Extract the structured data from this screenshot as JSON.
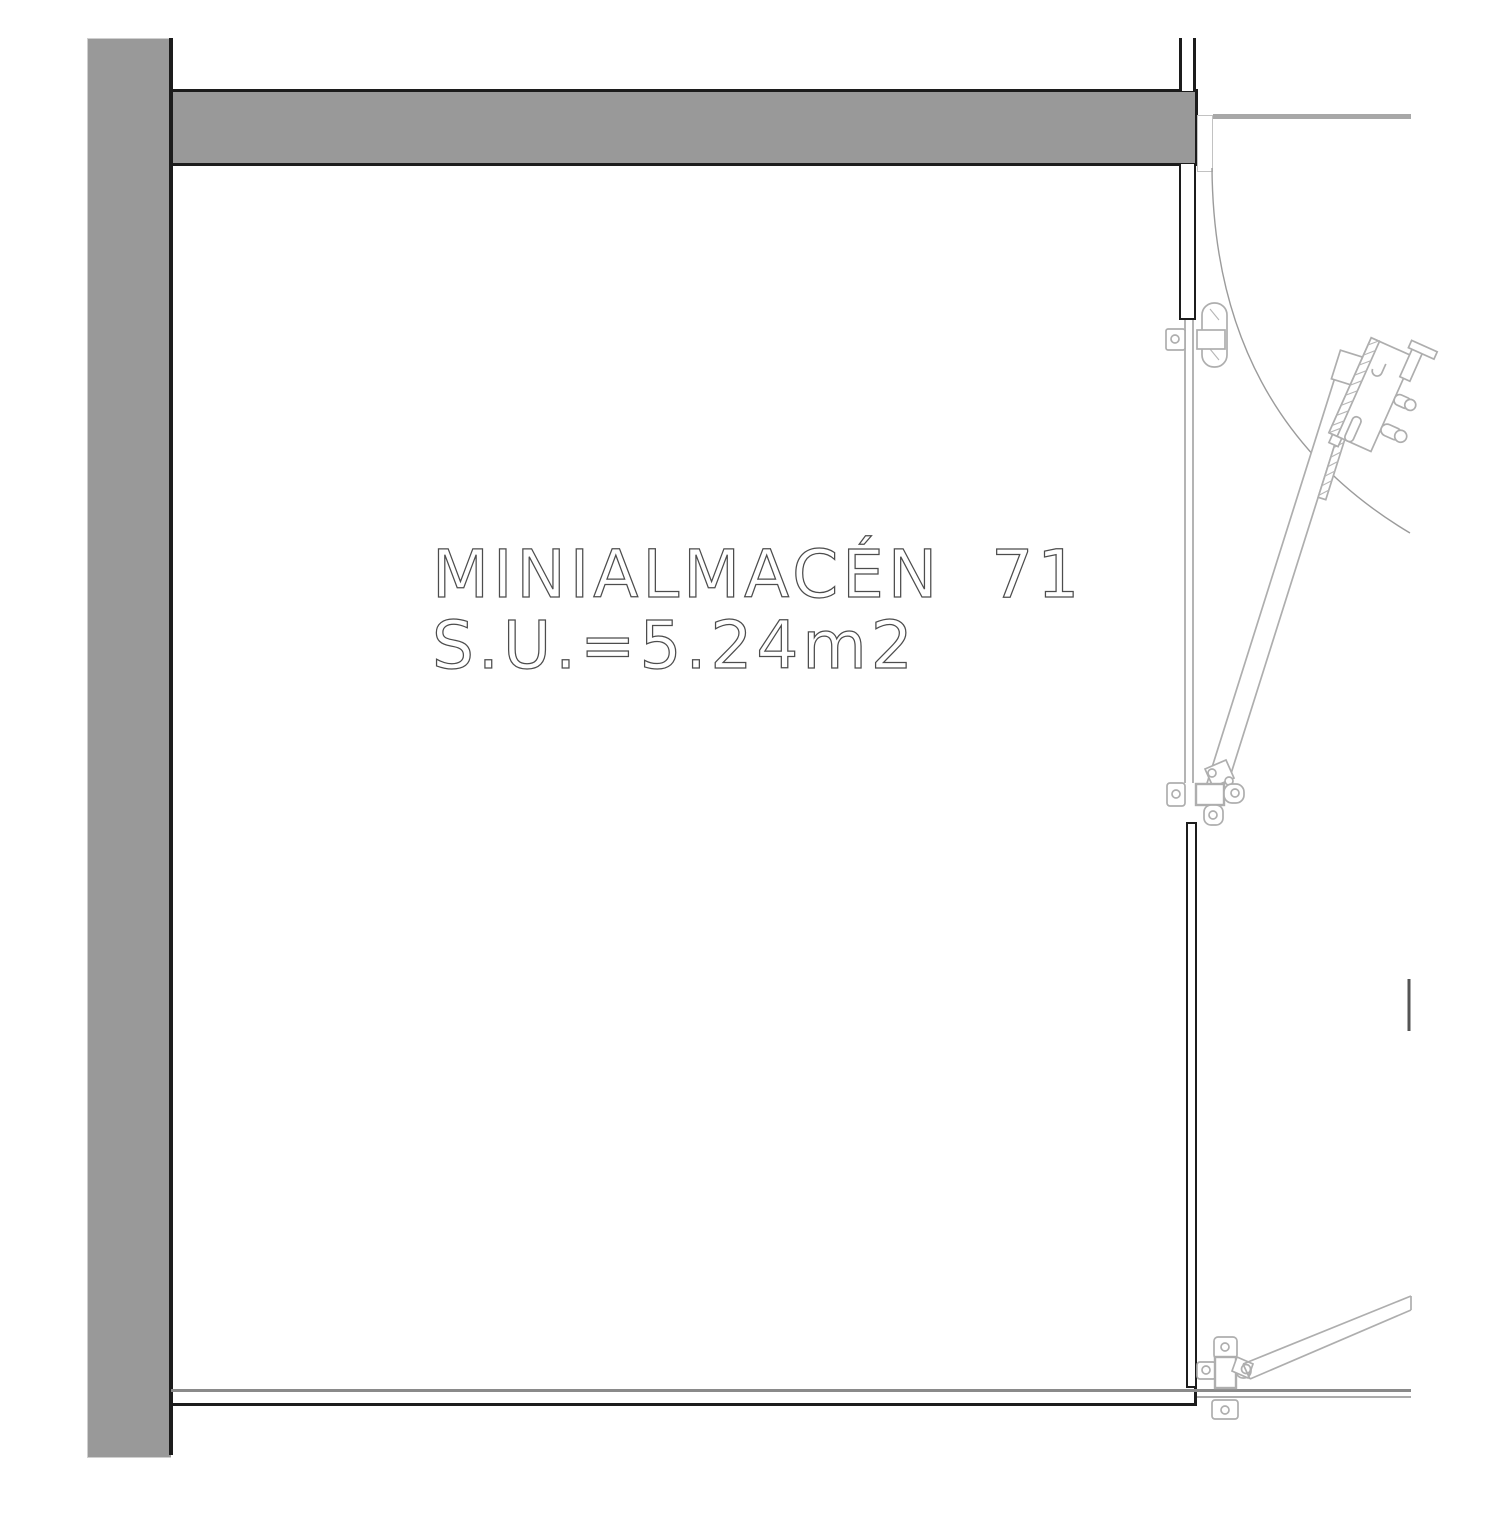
{
  "drawing": {
    "room_label": "MINIALMACÉN  71",
    "area_label": "S.U.=5.24m2",
    "room_name": "MINIALMACÉN",
    "room_number": "71",
    "usable_area_m2": "5.24"
  },
  "colors": {
    "wall_fill": "#999999",
    "wall_edge_black": "#1c1c1c",
    "hardware_line": "#aeaeae",
    "swing_arc": "#9b9b9b",
    "label_stroke": "#4d4d4d",
    "secondary_gray": "#ababab"
  },
  "icons": {
    "door_swing_arc": "quarter-circle swing path of open door",
    "hinges": "three pivot hinges on right jamb",
    "lock": "multi-point lock case with two bolts"
  }
}
